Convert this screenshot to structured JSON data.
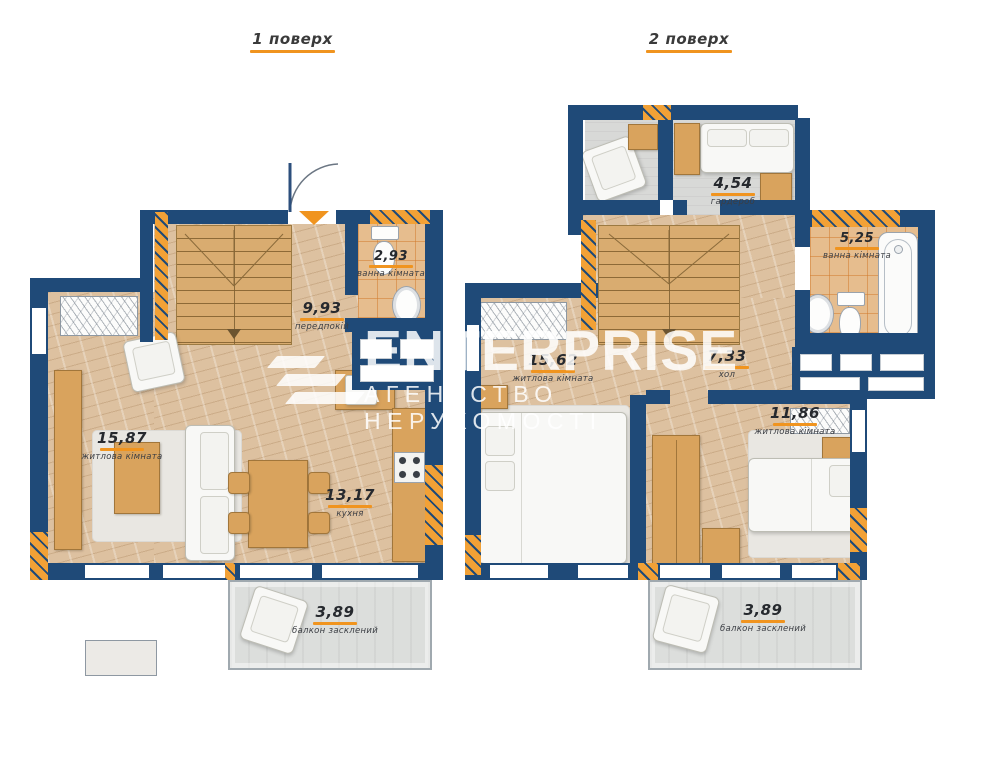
{
  "floor1": {
    "title": "1 поверх",
    "rooms": {
      "living": {
        "area": "15,87",
        "name": "житлова кімната"
      },
      "hallway": {
        "area": "9,93",
        "name": "передпокій"
      },
      "bathroom": {
        "area": "2,93",
        "name": "ванна кімната"
      },
      "kitchen": {
        "area": "13,17",
        "name": "кухня"
      },
      "balcony": {
        "area": "3,89",
        "name": "балкон засклений"
      }
    }
  },
  "floor2": {
    "title": "2 поверх",
    "rooms": {
      "wardrobe": {
        "area": "4,54",
        "name": "гардероб"
      },
      "bathroom": {
        "area": "5,25",
        "name": "ванна кімната"
      },
      "hall": {
        "area": "7,33",
        "name": "хол"
      },
      "bedroom1": {
        "area": "15,62",
        "name": "житлова кімната"
      },
      "bedroom2": {
        "area": "11,86",
        "name": "житлова кімната"
      },
      "balcony": {
        "area": "3,89",
        "name": "балкон засклений"
      }
    }
  },
  "watermark": {
    "brand": "ENTERPRISE",
    "subtitle": "АГЕНТСТВО НЕРУХОМОСТІ"
  },
  "colors": {
    "wall": "#1f4a78",
    "accent": "#f0941f",
    "hatch_a": "#f2a136",
    "wood": "#ddc1a0",
    "tile": "#e6bd8e"
  }
}
